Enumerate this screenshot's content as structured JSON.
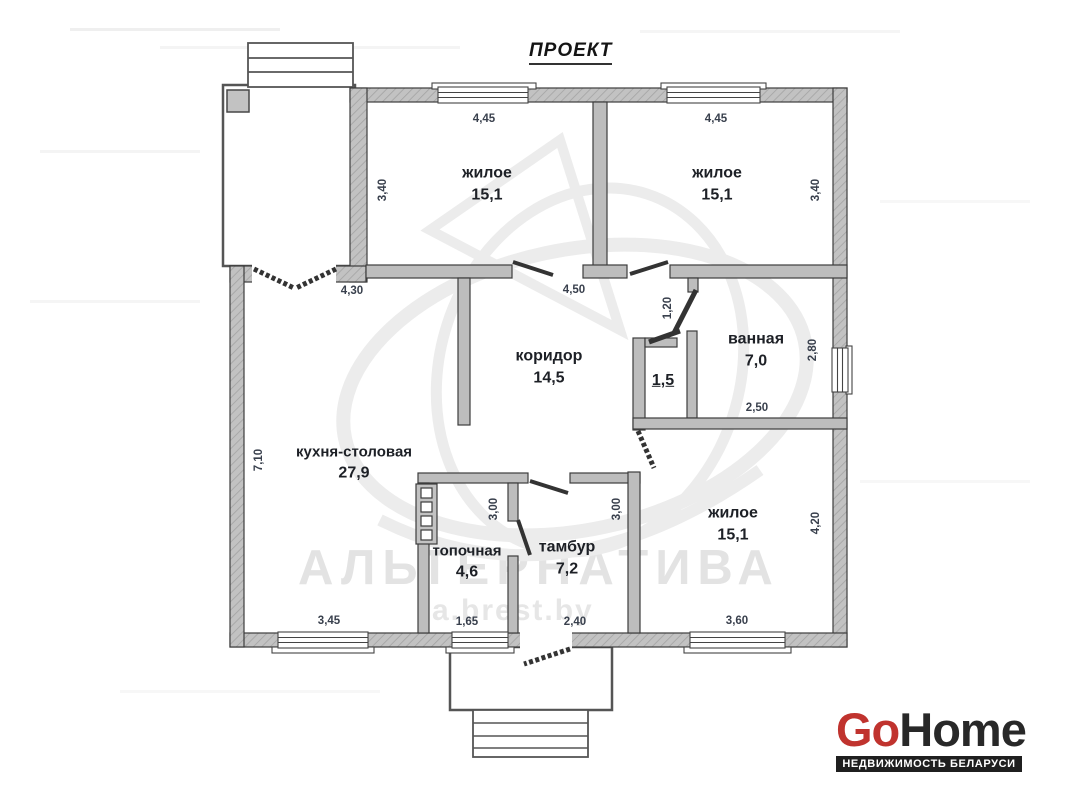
{
  "title": "ПРОЕКТ",
  "watermark": {
    "brand": "АЛЬТЕРНАТИВА",
    "site": "a.brest.by"
  },
  "rooms": [
    {
      "id": "living-top-left",
      "name": "жилое",
      "area": "15,1"
    },
    {
      "id": "living-top-right",
      "name": "жилое",
      "area": "15,1"
    },
    {
      "id": "corridor",
      "name": "коридор",
      "area": "14,5"
    },
    {
      "id": "bathroom",
      "name": "ванная",
      "area": "7,0"
    },
    {
      "id": "wc",
      "name": "",
      "area": "1,5"
    },
    {
      "id": "kitchen-dining",
      "name": "кухня-столовая",
      "area": "27,9"
    },
    {
      "id": "boiler-room",
      "name": "топочная",
      "area": "4,6"
    },
    {
      "id": "vestibule",
      "name": "тамбур",
      "area": "7,2"
    },
    {
      "id": "living-bottom",
      "name": "жилое",
      "area": "15,1"
    }
  ],
  "dimensions": {
    "top_left_room_width": "4,45",
    "top_left_room_height": "3,40",
    "top_right_room_width": "4,45",
    "top_right_room_height": "3,40",
    "kitchen_top_width": "4,30",
    "corridor_width": "4,50",
    "wc_entry_width": "1,20",
    "bathroom_height": "2,80",
    "bathroom_width": "2,50",
    "kitchen_height": "7,10",
    "boiler_room_height": "3,00",
    "vestibule_height": "3,00",
    "living_bottom_height": "4,20",
    "kitchen_bottom_width": "3,45",
    "boiler_room_width": "1,65",
    "vestibule_width": "2,40",
    "living_bottom_width": "3,60"
  },
  "logo": {
    "part1": "Go",
    "part2": "Home",
    "tagline": "НЕДВИЖИМОСТЬ БЕЛАРУСИ"
  },
  "colors": {
    "accent_red": "#c0332e",
    "logo_dark": "#282828",
    "wall_fill": "#bdbdbd",
    "label_color": "#1d2026",
    "dimension_color": "#39404d",
    "watermark_color": "#e3e3e3"
  }
}
